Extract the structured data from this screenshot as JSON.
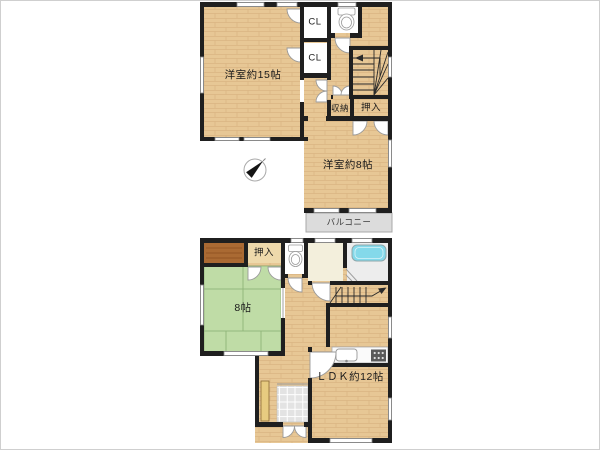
{
  "plan": {
    "floor2": {
      "room15_label": "洋室約15帖",
      "closet1_label": "CL",
      "closet2_label": "CL",
      "storage_label": "収納",
      "oshiire_label": "押入",
      "room8_label": "洋室約8帖",
      "balcony_label": "バルコニー"
    },
    "floor1": {
      "oshiire_label": "押入",
      "tatami_room_label": "8帖",
      "ldk_label": "ＬＤＫ約12帖"
    },
    "colors": {
      "wall": "#1f1f1f",
      "wood_floor": "#e7c795",
      "tatami": "#c3e0ab",
      "balcony": "#dcdcdc",
      "bathtub": "#84d9ea",
      "entrance_tile": "#e3e3e3",
      "closet_wood": "#aa6a33",
      "background": "#ffffff"
    }
  }
}
